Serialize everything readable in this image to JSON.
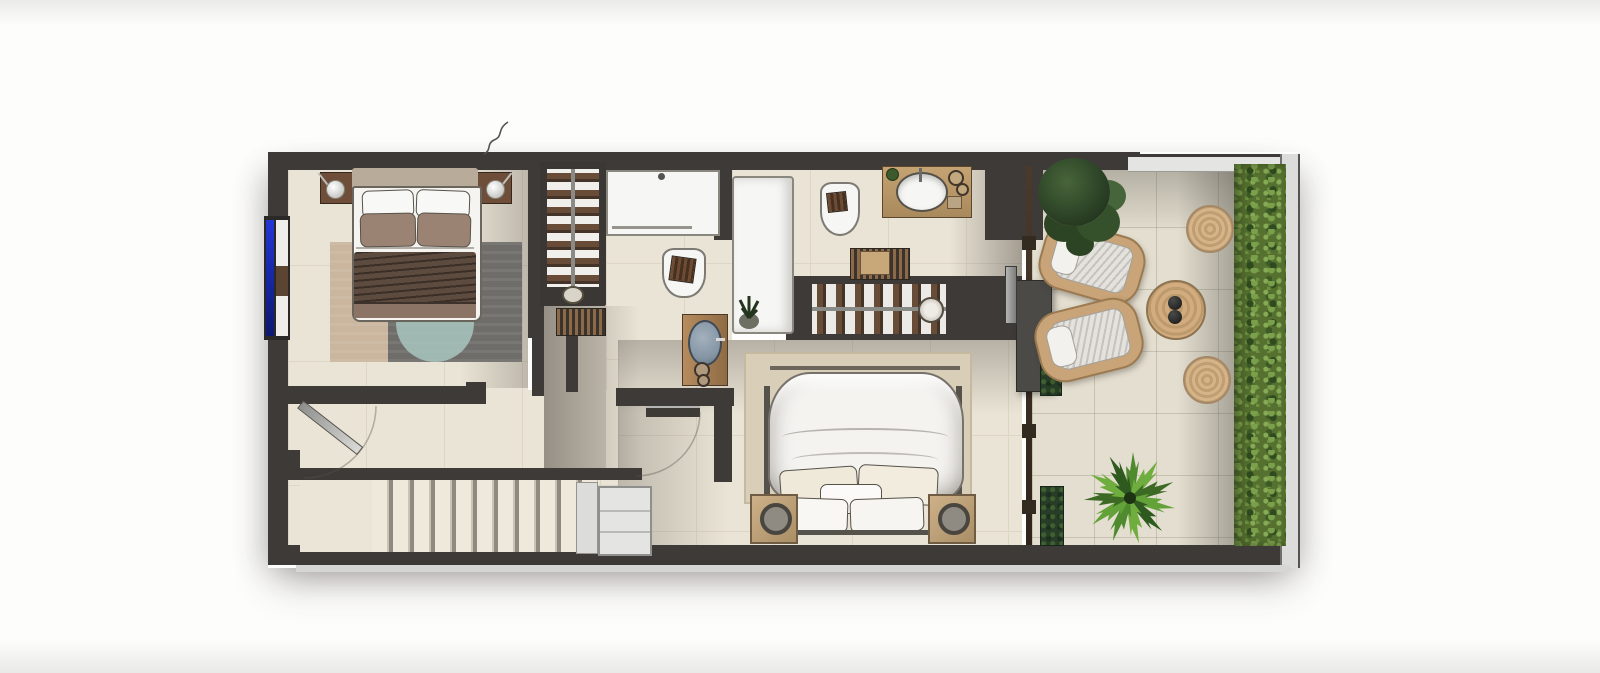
{
  "scene": {
    "kind": "architectural-floor-plan",
    "style": "photorealistic top-down 3D render",
    "text_visible": false
  },
  "palette": {
    "wall": "#3d3a37",
    "wall_dark": "#2b2927",
    "floor": "#eae4d6",
    "floor_shade": "#b9b1a4",
    "terrace_floor": "#e3decf",
    "tile_line": "#ddd6c6",
    "linen_white": "#f5f4f1",
    "pillow_brown": "#9b8373",
    "blanket_brown": "#5e4b3f",
    "blanket_light": "#8b7365",
    "headboard_tan": "#b9ab99",
    "rug_tan": "#cab69e",
    "rug_grey": "#6e6d69",
    "rug_teal": "#a9c6bf",
    "rug_master": "#d9ceb7",
    "wood_dark": "#6e4e38",
    "wood_warm": "#b68c5e",
    "wood_light": "#ceb189",
    "basin_blue": "#8494a3",
    "fixture_white": "#f6f6f4",
    "glass_blue": "#2336d6",
    "rail_light": "#e4e4e2",
    "rattan": "#c9a478",
    "pouf": "#d6b489",
    "hedge": "#55702f",
    "tree": "#33502a",
    "palm": "#63a238",
    "planter": "#273d27",
    "mullion": "#4a3a2c"
  },
  "rooms": [
    {
      "id": "bedroom-1",
      "position": "left",
      "furniture": [
        "double-bed",
        "headboard",
        "white-pillows x2",
        "brown-pillows x2",
        "brown-throw-blanket",
        "nightstand x2",
        "ball-lamp x2",
        "layered-rug-with-teal-circle",
        "tall-wardrobe-with-hanging-clothes",
        "slatted-wood-mat",
        "blue-glazed-window"
      ]
    },
    {
      "id": "hallway-stairs",
      "position": "lower-left",
      "furniture": [
        "entry-door-with-swing-arc",
        "staircase",
        "stair-landing",
        "white-storage-cabinet"
      ]
    },
    {
      "id": "bathroom-1",
      "position": "center",
      "furniture": [
        "walk-in-shower",
        "tall-shower-enclosure",
        "corner-plant",
        "toilet-with-towel",
        "wood-vanity-blue-basin",
        "round-jars x2"
      ]
    },
    {
      "id": "ensuite-bathroom-closet",
      "position": "center-right",
      "furniture": [
        "toilet-with-towel",
        "wood-vanity-white-oval-basin",
        "slatted-bench-with-basket",
        "open-wardrobe-hanging-clothes",
        "round-basket"
      ]
    },
    {
      "id": "master-bedroom",
      "position": "right",
      "furniture": [
        "king-bed-white-duvet",
        "cream-pillows x5",
        "area-rug",
        "wood-nightstand-with-speaker x2",
        "wall-tv-panel",
        "sliding-glass-door",
        "door-with-swing-arc"
      ]
    },
    {
      "id": "terrace",
      "position": "far-right",
      "furniture": [
        "dark-green-tree",
        "rattan-lounge-chair x2",
        "round-rattan-coffee-table",
        "black-decor-balls x2",
        "rattan-pouf x2",
        "fan-palm-plant",
        "planter-box x2",
        "privacy-hedge",
        "glass-railing"
      ]
    }
  ],
  "counts": {
    "stair_treads": 11,
    "beds": 2,
    "toilets": 2,
    "showers": 2,
    "vanities": 2,
    "wardrobes": 2,
    "lounge_chairs": 2,
    "poufs": 2,
    "planters": 2
  }
}
